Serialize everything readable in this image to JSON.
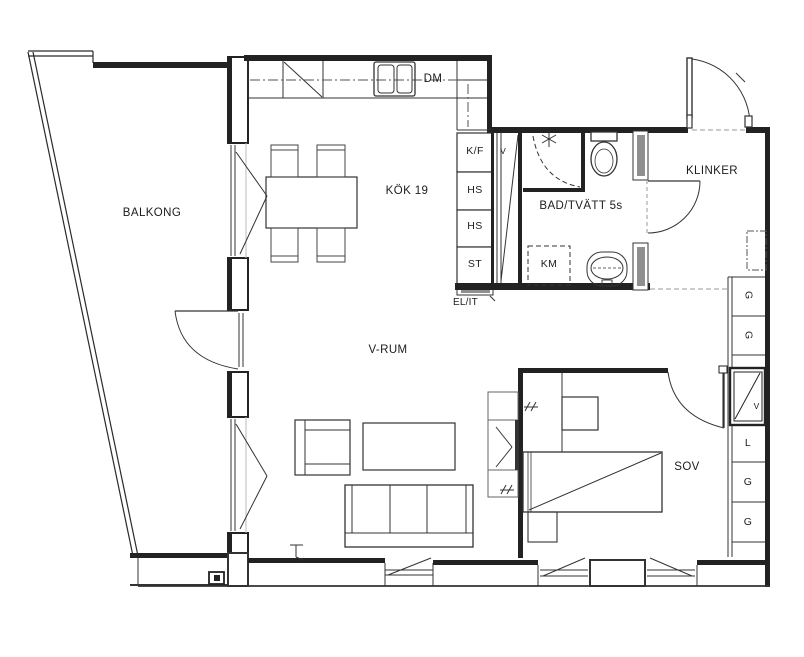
{
  "colors": {
    "background": "#ffffff",
    "line": "#222222",
    "wall_fill": "#222222",
    "panel_gray": "#8f8f8f",
    "window_accent": "#b9bac4"
  },
  "rooms": {
    "balcony": "BALKONG",
    "kitchen": "KÖK 19",
    "living_room": "V-RUM",
    "bedroom": "SOV",
    "bathroom": "BAD/TVÄTT 5s",
    "hallway_floor": "KLINKER"
  },
  "kitchen": {
    "dishwasher": "DM",
    "vent_shaft": "V",
    "cabinets": [
      "K/F",
      "HS",
      "HS",
      "ST"
    ],
    "electrical": "EL/IT"
  },
  "bathroom_fixtures": {
    "washing_machine": "KM"
  },
  "closets": [
    "G",
    "G",
    "V",
    "L",
    "G",
    "G"
  ]
}
